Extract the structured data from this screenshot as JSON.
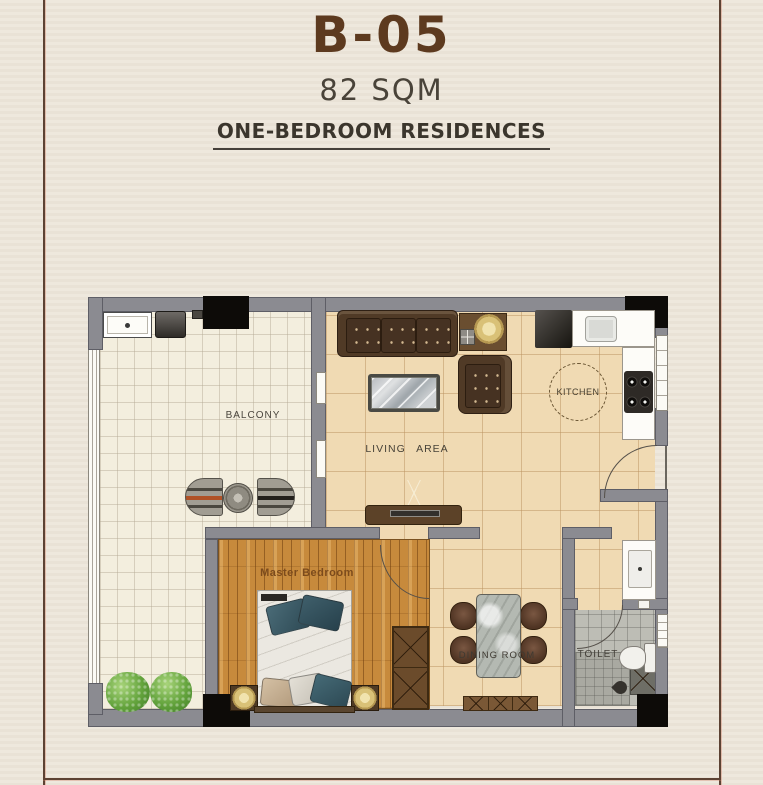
{
  "header": {
    "title": "B-05",
    "area": "82 SQM",
    "type": "ONE-BEDROOM RESIDENCES"
  },
  "rooms": {
    "balcony": "BALCONY",
    "living_area": "LIVING AREA",
    "kitchen": "KITCHEN",
    "master_bedroom": "Master Bedroom",
    "dining_room": "DINING ROOM",
    "toilet": "TOILET"
  },
  "colors": {
    "accent_brown": "#5d3a1f",
    "text_dark": "#3b362d",
    "border_line": "#5c4233",
    "wall_gray": "#8b8b91",
    "column_black": "#0d0b08",
    "balcony_floor": "#f3eede",
    "living_floor": "#f0dab3",
    "bedroom_floor": "#c78a3c",
    "toilet_floor": "#bdbdb5",
    "counter_white": "#fdfcf8",
    "furniture_brown": "#503a26",
    "lamp_gold": "#dfc784",
    "plant_green": "#63a33c",
    "pillow_teal": "#3f5f6b"
  }
}
